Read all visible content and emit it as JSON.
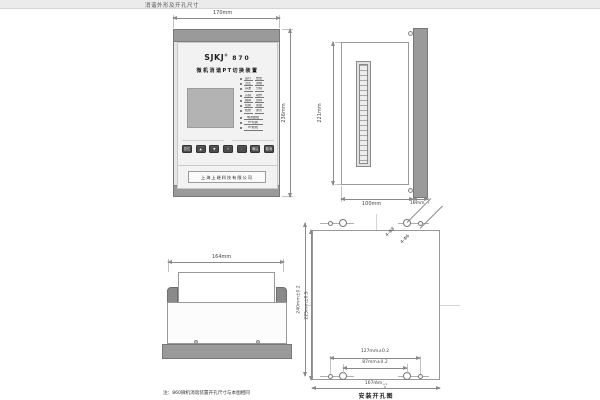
{
  "page": {
    "title": "消谐外形及开孔尺寸"
  },
  "front_view": {
    "width_dim": "170mm",
    "height_dim": "236mm",
    "brand": "SJKJ",
    "brand_reg": "®",
    "model": "870",
    "subtitle": "微机消谐PT切换装置",
    "indicator_pairs": [
      [
        "运行",
        "告警"
      ],
      [
        "过压",
        "谐振"
      ],
      [
        "基波",
        "分频"
      ],
      [
        "高频",
        "动作"
      ],
      [
        "跳闸",
        "合闸"
      ],
      [
        "切换",
        "闭锁"
      ],
      [
        "检修",
        "通讯"
      ]
    ],
    "indicator_wide": [
      "电源故障",
      "PT切换",
      "PT断线"
    ],
    "buttons": [
      "复位",
      "▲",
      "▼",
      "+",
      "-",
      "确认",
      "取消"
    ],
    "company": "上海上继科技有限公司"
  },
  "side_view": {
    "height_dim": "221mm",
    "depth_dim": "100mm",
    "bezel_dim": "19mm"
  },
  "top_view": {
    "width_dim": "164mm",
    "note": "注：860微机消谐装置开孔尺寸与本图相同"
  },
  "cutout_view": {
    "caption": "安装开孔图",
    "height_outer_dim": "240mm±0.2",
    "height_inner_dim": "225mm±0.5",
    "holes_outer_dim": "127mm±0.2",
    "holes_inner_dim": "87mm±0.2",
    "width_dim": "167mm",
    "width_tol_sup": "+1",
    "width_tol_sub": "0",
    "hole_label_a": "4-Φ8",
    "hole_label_b": "4-Φ6"
  }
}
